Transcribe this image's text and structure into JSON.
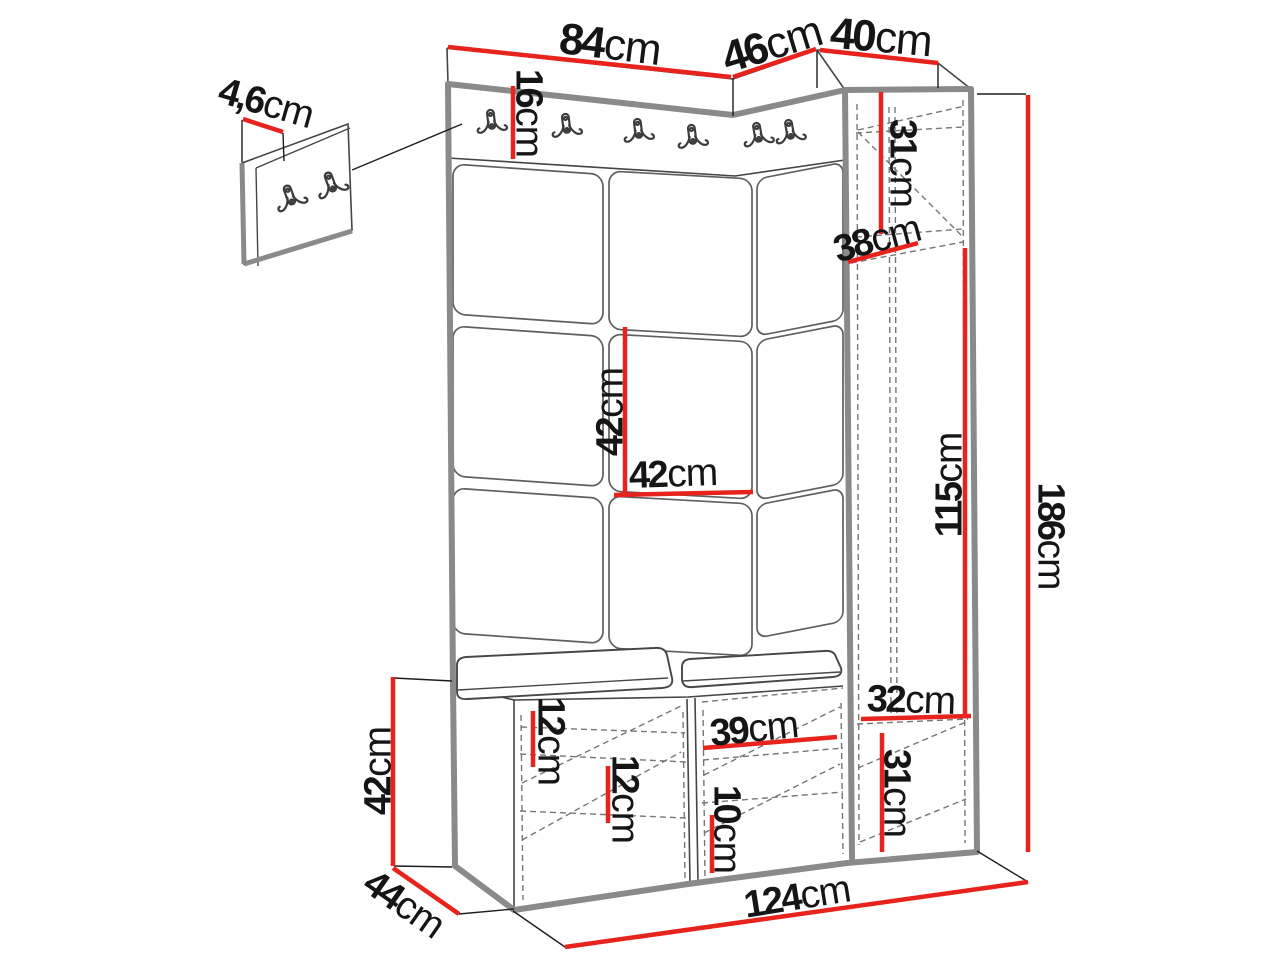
{
  "meta": {
    "type": "furniture-technical-dimension-diagram",
    "subject": "hallway wardrobe set with coat hooks, upholstered wall panels, corner cabinet and shoe bench",
    "units": "cm"
  },
  "colors": {
    "background": "#ffffff",
    "dimension_red": "#e8231d",
    "edge_thick_gray": "#8a8a8a",
    "edge_thin": "#454545",
    "dashed_hidden": "#767676",
    "label_text": "#151515"
  },
  "icons": {
    "coat-hook": "double-prong-wall-hook-icon"
  },
  "hooks": {
    "rail_count": 6,
    "small_panel_count": 2
  },
  "dims": {
    "d84": {
      "num": "84",
      "unit": "cm",
      "value": 84,
      "measures": "width of left panel section"
    },
    "d46": {
      "num": "46",
      "unit": "cm",
      "value": 46,
      "measures": "width of angled corner section"
    },
    "d40": {
      "num": "40",
      "unit": "cm",
      "value": 40,
      "measures": "width of tall cabinet"
    },
    "d4_6": {
      "num": "4,6",
      "unit": "cm",
      "value": 4.6,
      "measures": "thickness of small hook panel"
    },
    "d16": {
      "num": "16",
      "unit": "cm",
      "value": 16,
      "measures": "height of hook rail"
    },
    "d31top": {
      "num": "31",
      "unit": "cm",
      "value": 31,
      "measures": "height of cabinet top compartment"
    },
    "d38": {
      "num": "38",
      "unit": "cm",
      "value": 38,
      "measures": "internal depth of cabinet shelf"
    },
    "d42v": {
      "num": "42",
      "unit": "cm",
      "value": 42,
      "measures": "upholstered panel height"
    },
    "d42h": {
      "num": "42",
      "unit": "cm",
      "value": 42,
      "measures": "upholstered panel width"
    },
    "d115": {
      "num": "115",
      "unit": "cm",
      "value": 115,
      "measures": "height of cabinet middle compartment"
    },
    "d186": {
      "num": "186",
      "unit": "cm",
      "value": 186,
      "measures": "total height"
    },
    "d32": {
      "num": "32",
      "unit": "cm",
      "value": 32,
      "measures": "width of cabinet bottom compartment"
    },
    "d31bottom": {
      "num": "31",
      "unit": "cm",
      "value": 31,
      "measures": "height of cabinet bottom compartment"
    },
    "d12a": {
      "num": "12",
      "unit": "cm",
      "value": 12,
      "measures": "bench upper shelf height"
    },
    "d12b": {
      "num": "12",
      "unit": "cm",
      "value": 12,
      "measures": "bench lower shelf height"
    },
    "d39": {
      "num": "39",
      "unit": "cm",
      "value": 39,
      "measures": "bench right compartment width"
    },
    "d10": {
      "num": "10",
      "unit": "cm",
      "value": 10,
      "measures": "bench bottom shelf height"
    },
    "d42bench": {
      "num": "42",
      "unit": "cm",
      "value": 42,
      "measures": "bench height"
    },
    "d44": {
      "num": "44",
      "unit": "cm",
      "value": 44,
      "measures": "bench depth"
    },
    "d124": {
      "num": "124",
      "unit": "cm",
      "value": 124,
      "measures": "total width"
    }
  }
}
